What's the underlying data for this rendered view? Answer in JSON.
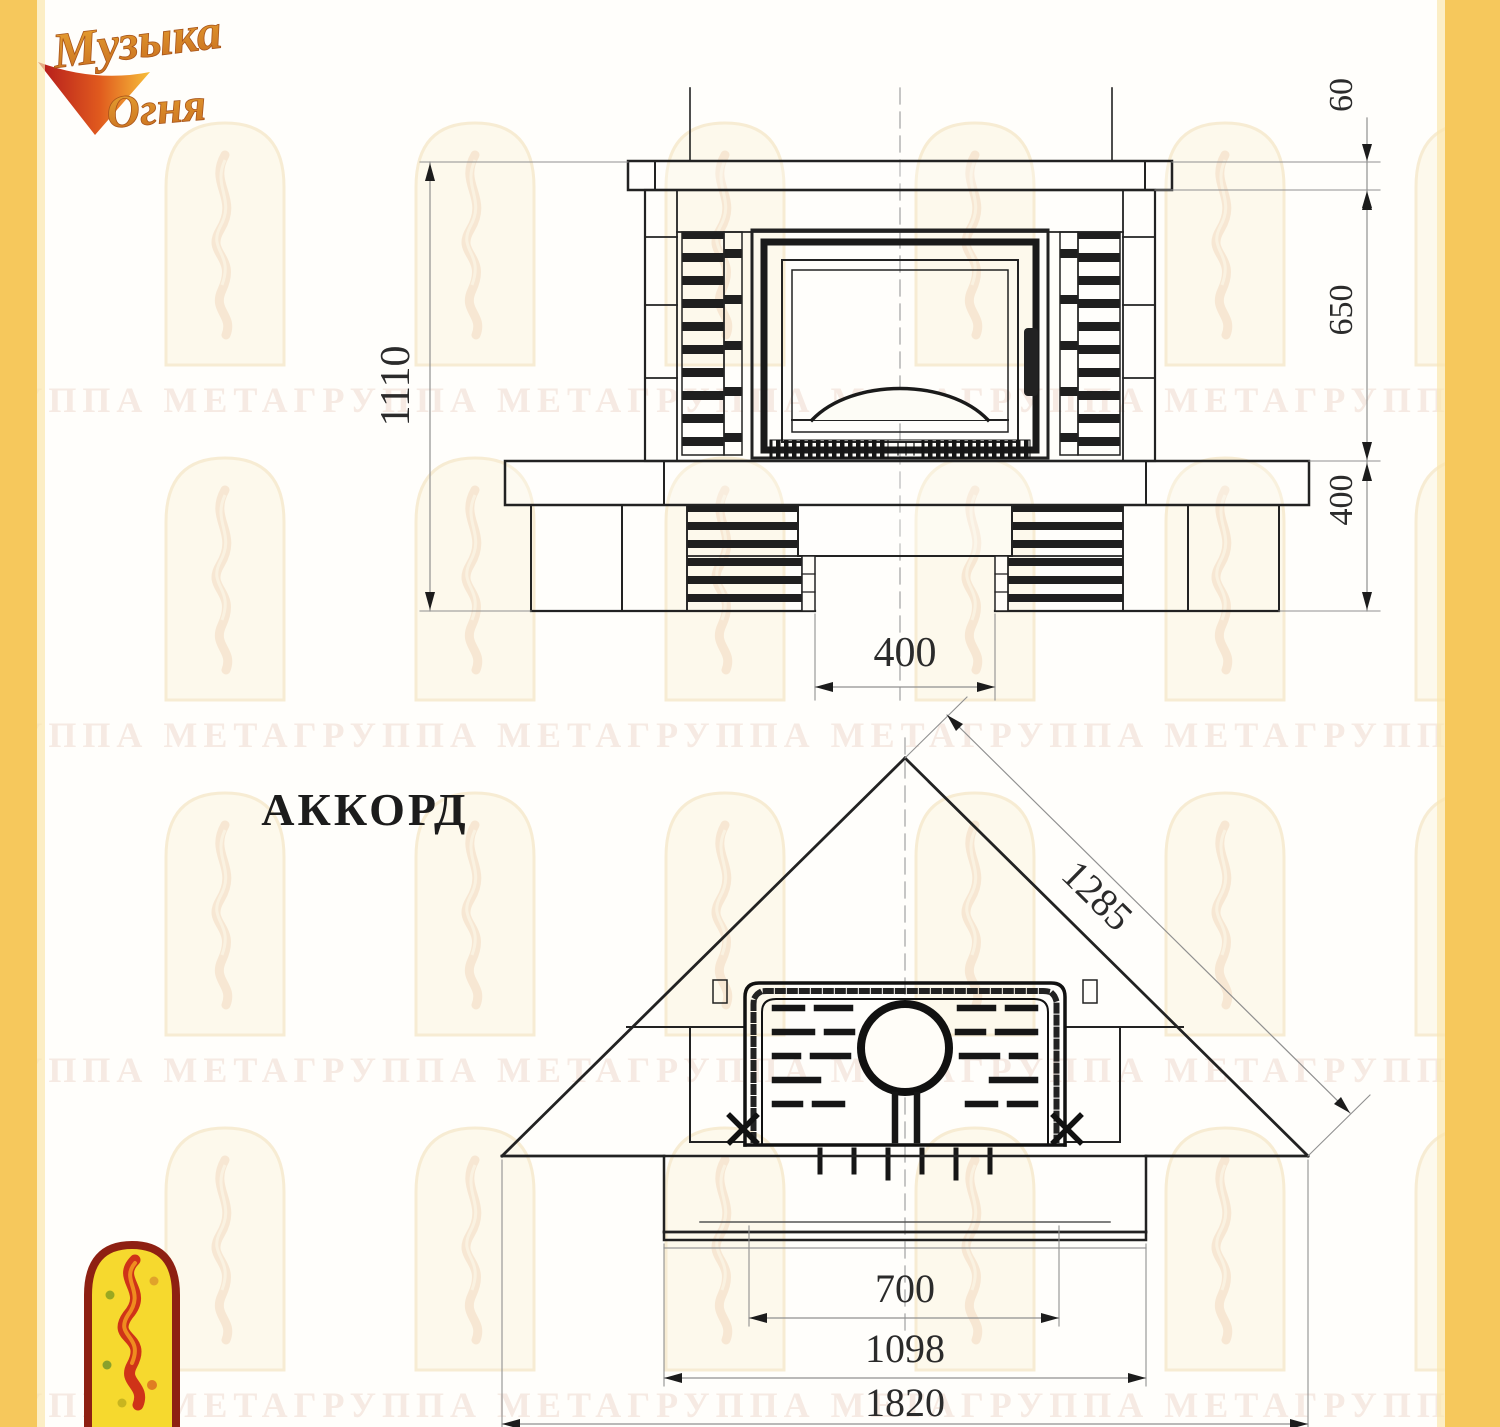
{
  "window": {
    "width": 1500,
    "height": 1427
  },
  "logo": {
    "word1": "Музыка",
    "word2": "Огня"
  },
  "title": {
    "model_name": "АККОРД"
  },
  "watermark": {
    "row_text": "ГРУППА МЕТАГРУППА МЕТАГРУППА МЕТАГРУППА МЕТАГРУППА МЕТА"
  },
  "front_view": {
    "name": "front elevation of fireplace",
    "dim_total_height": "1110",
    "dim_mantel_height": "60",
    "dim_firebox_zone_height": "650",
    "dim_base_height": "400",
    "dim_base_opening_width": "400"
  },
  "plan_view": {
    "name": "plan view of corner fireplace",
    "dim_diagonal": "1285",
    "dim_opening_width": "700",
    "dim_platform_width": "1098",
    "dim_overall_width": "1820"
  },
  "colors": {
    "accent_yellow": "#f6c85c",
    "drawing_line": "#222222",
    "dimension_line": "#909090",
    "dimension_text": "#2b2b2b",
    "logo_orange": "#d97b24",
    "logo_red": "#bf2b18",
    "emblem_yellow": "#f6d92e",
    "emblem_border": "#8e2012",
    "watermark_tint": "#e8cfc0"
  }
}
